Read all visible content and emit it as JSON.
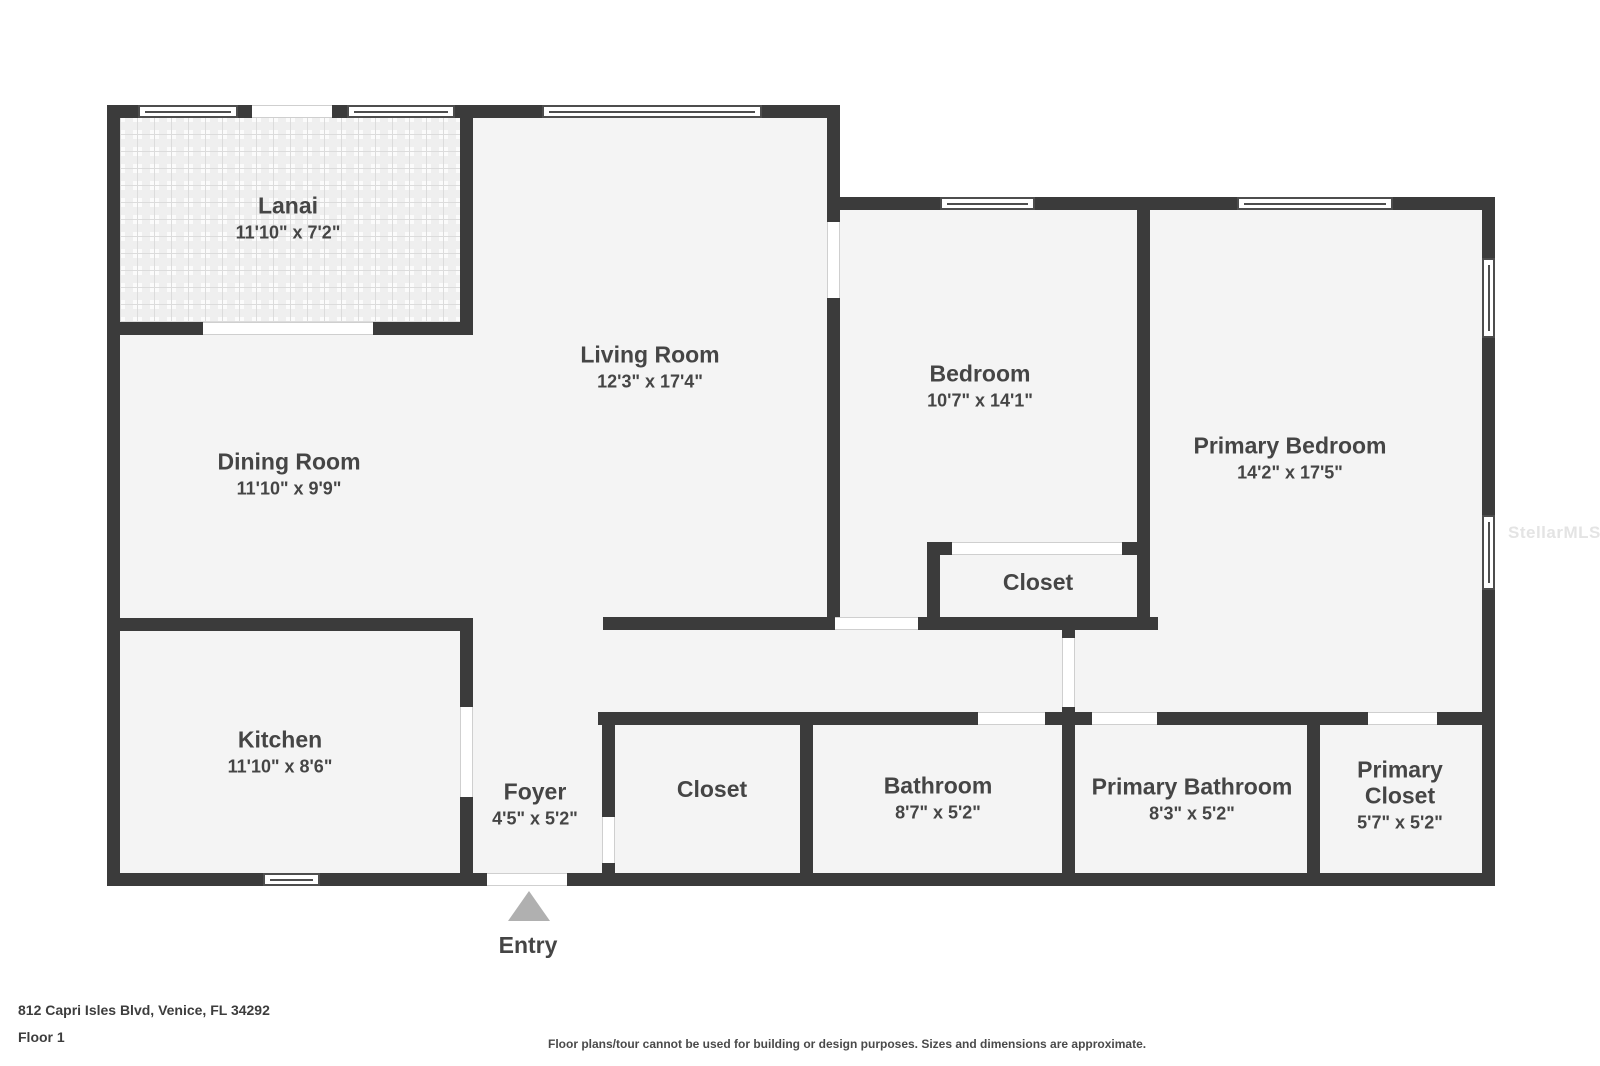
{
  "plan": {
    "watermark": "StellarMLS",
    "entry_label": "Entry",
    "rooms": [
      {
        "name": "Lanai",
        "dims": "11'10\" x 7'2\""
      },
      {
        "name": "Living Room",
        "dims": "12'3\" x 17'4\""
      },
      {
        "name": "Dining Room",
        "dims": "11'10\" x 9'9\""
      },
      {
        "name": "Bedroom",
        "dims": "10'7\" x 14'1\""
      },
      {
        "name": "Primary Bedroom",
        "dims": "14'2\" x 17'5\""
      },
      {
        "name": "Closet"
      },
      {
        "name": "Kitchen",
        "dims": "11'10\" x 8'6\""
      },
      {
        "name": "Foyer",
        "dims": "4'5\" x 5'2\""
      },
      {
        "name": "Closet"
      },
      {
        "name": "Bathroom",
        "dims": "8'7\" x 5'2\""
      },
      {
        "name": "Primary Bathroom",
        "dims": "8'3\" x 5'2\""
      },
      {
        "name": "Primary Closet",
        "dims": "5'7\" x 5'2\""
      }
    ]
  },
  "footer": {
    "address": "812 Capri Isles Blvd, Venice, FL 34292",
    "floor": "Floor 1",
    "disclaimer": "Floor plans/tour cannot be used for building or design purposes. Sizes and dimensions are approximate."
  },
  "colors": {
    "wall": "#3b3b3b",
    "floor": "#f4f4f4",
    "text": "#454545",
    "entry_arrow": "#b0b0b0",
    "watermark": "#e4e4e4"
  }
}
